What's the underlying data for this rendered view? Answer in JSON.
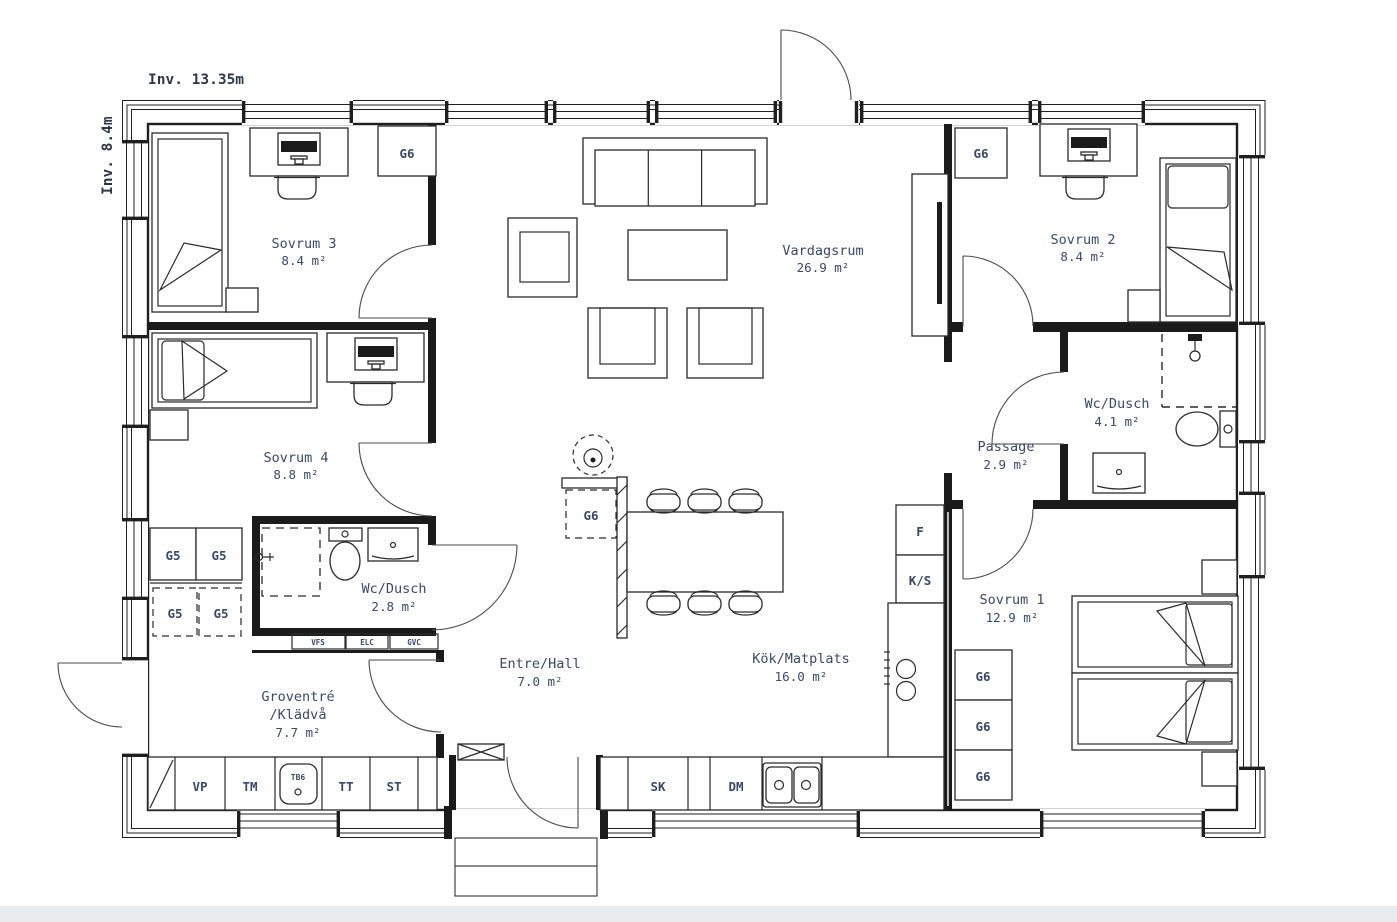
{
  "plan": {
    "title": "House floor plan",
    "dimensions": {
      "width_label": "Inv. 13.35m",
      "height_label": "Inv. 8.4m"
    },
    "rooms": {
      "sovrum3": {
        "name": "Sovrum 3",
        "area": "8.4 m²"
      },
      "sovrum4": {
        "name": "Sovrum 4",
        "area": "8.8 m²"
      },
      "vardagsrum": {
        "name": "Vardagsrum",
        "area": "26.9 m²"
      },
      "sovrum2": {
        "name": "Sovrum 2",
        "area": "8.4 m²"
      },
      "wc_dusch_stor": {
        "name": "Wc/Dusch",
        "area": "4.1 m²"
      },
      "passage": {
        "name": "Passage",
        "area": "2.9 m²"
      },
      "sovrum1": {
        "name": "Sovrum 1",
        "area": "12.9 m²"
      },
      "wc_dusch_liten": {
        "name": "Wc/Dusch",
        "area": "2.8 m²"
      },
      "entre": {
        "name": "Entre/Hall",
        "area": "7.0 m²"
      },
      "kok": {
        "name": "Kök/Matplats",
        "area": "16.0 m²"
      },
      "groventre": {
        "name": "Groventré",
        "name2": "/Klädvå",
        "area": "7.7 m²"
      }
    },
    "codes": {
      "g6": "G6",
      "g5": "G5",
      "f": "F",
      "ks": "K/S",
      "sk": "SK",
      "dm": "DM",
      "vp": "VP",
      "tm": "TM",
      "tb6": "TB6",
      "tt": "TT",
      "st": "ST",
      "vfs": "VFS",
      "elc": "ELC",
      "gvc": "GVC"
    },
    "colors": {
      "label": "#39486b",
      "line": "#1f1f1f",
      "bottom_bar": "#e9ecef"
    }
  }
}
